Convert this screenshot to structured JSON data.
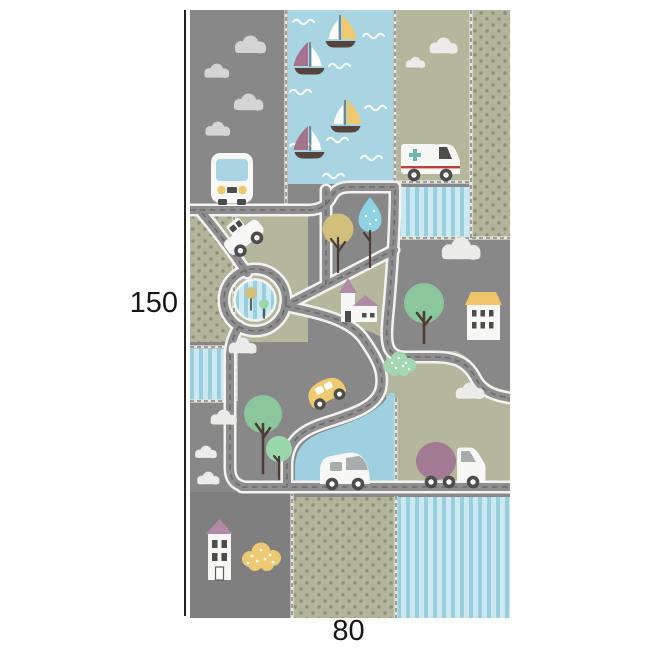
{
  "diagram": {
    "height_label": "150",
    "width_label": "80"
  },
  "colors": {
    "gray_block": "#888888",
    "gray_dark": "#7f7f7f",
    "olive": "#b5b79c",
    "olive_dot_bg": "#b3b59b",
    "olive_dot": "#8c8e76",
    "water_blue": "#a9d4e2",
    "water_blue_deep": "#9fd0e0",
    "stripe_light": "#cde8f0",
    "stripe_dark": "#97cfdf",
    "road_casing": "#f3f3f1",
    "road_surface": "#8e8e8e",
    "road_dash": "#6b6b6b",
    "stitch_base": "#e6e6e2",
    "stitch_dash": "#73736c",
    "vehicle_white": "#f7f7f5",
    "cloud_gray": "#d4d4d4",
    "cloud_white": "#ebebe9",
    "accent_yellow": "#eec96f",
    "accent_mauve": "#a27a93",
    "hull_brown": "#55453e",
    "detail_dark": "#4c4c4c",
    "window_gray": "#a7adad",
    "cross_teal": "#6fb5ad",
    "stripe_red": "#bb4038",
    "tree_green": "#8cc79b",
    "tree_light_green": "#9ad8ab",
    "tree_olive": "#d0c07c",
    "tree_blue": "#8ed2e3",
    "trunk_brown": "#4a3d36",
    "bush_green": "#a3d7b1",
    "bush_yellow": "#ecca74",
    "roof_mauve": "#b18ba5",
    "roof_yellow": "#f0c468",
    "sail_yellow": "#eec96f",
    "sail_mauve": "#a5748c",
    "dim_line": "#222222",
    "text_dark": "#161616"
  },
  "rug": {
    "description": "children road play rug illustration with dimension lines",
    "icons": [
      "cloud-icon",
      "bus-icon",
      "sailboat-icon",
      "wave-icon",
      "ambulance-icon",
      "car-icon",
      "roundabout",
      "tree-icon",
      "teardrop-tree-icon",
      "church-icon",
      "house-icon",
      "beetle-car-icon",
      "van-icon",
      "mixer-truck-icon",
      "tall-house-icon",
      "bush-icon"
    ]
  }
}
